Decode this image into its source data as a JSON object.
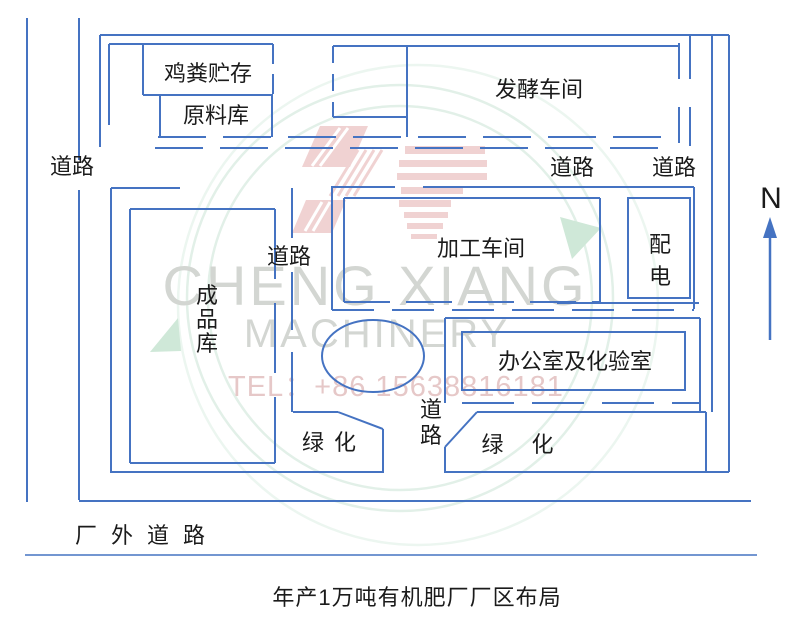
{
  "caption": {
    "text": "年产1万吨有机肥厂厂区布局"
  },
  "colors": {
    "line": "#4573c2",
    "text": "#1b1b1b",
    "bg": "#ffffff"
  },
  "compass": {
    "label": "N",
    "line": {
      "x": 770,
      "y1": 236,
      "y2": 340
    },
    "head_points": "770,217 763,238 777,238"
  },
  "labels": [
    {
      "name": "label-chicken-manure-storage",
      "text": "鸡粪贮存",
      "x": 208,
      "y": 81,
      "fs": 22
    },
    {
      "name": "label-raw-material-warehouse",
      "text": "原料库",
      "x": 216,
      "y": 123,
      "fs": 22
    },
    {
      "name": "label-fermentation-workshop",
      "text": "发酵车间",
      "x": 539,
      "y": 97,
      "fs": 22
    },
    {
      "name": "label-road-west",
      "text": "道路",
      "x": 72,
      "y": 174,
      "fs": 22
    },
    {
      "name": "label-road-mid-east",
      "text": "道路",
      "x": 572,
      "y": 175,
      "fs": 22
    },
    {
      "name": "label-road-east",
      "text": "道路",
      "x": 674,
      "y": 175,
      "fs": 22
    },
    {
      "name": "label-road-mid-west",
      "text": "道路",
      "x": 289,
      "y": 264,
      "fs": 22
    },
    {
      "name": "label-processing-workshop",
      "text": "加工车间",
      "x": 481,
      "y": 256,
      "fs": 22
    },
    {
      "name": "label-power-distribution",
      "text": "配电",
      "x": 660,
      "y": 252,
      "fs": 22,
      "vertical": true,
      "lh": 32
    },
    {
      "name": "label-finished-product-warehouse",
      "text": "成品库",
      "x": 207,
      "y": 303,
      "fs": 22,
      "vertical": true,
      "lh": 24
    },
    {
      "name": "label-office-and-lab",
      "text": "办公室及化验室",
      "x": 575,
      "y": 369,
      "fs": 22
    },
    {
      "name": "label-road-center",
      "text": "道路",
      "x": 431,
      "y": 417,
      "fs": 22,
      "vertical": true,
      "lh": 26
    },
    {
      "name": "label-green-area-west",
      "text": "绿 化",
      "x": 330,
      "y": 450,
      "fs": 22,
      "ls": 2
    },
    {
      "name": "label-green-area-east",
      "text": "绿 化",
      "x": 523,
      "y": 452,
      "fs": 22,
      "ls": 11
    },
    {
      "name": "label-outside-road",
      "text": "厂外道路",
      "x": 75,
      "y": 543,
      "fs": 22,
      "ls": 14,
      "anchor": "start"
    },
    {
      "name": "north-label",
      "text": "N",
      "x": 771,
      "y": 208,
      "fs": 30
    }
  ],
  "ellipse": {
    "name": "center-roundabout",
    "cx": 373,
    "cy": 356,
    "rx": 51,
    "ry": 36
  },
  "lines": [
    {
      "n": "outer-road-left-line-outer",
      "d": "M27,18 V502"
    },
    {
      "n": "outer-road-left-line-inner-a",
      "d": "M79,18 V160"
    },
    {
      "n": "outer-road-left-line-inner-b",
      "d": "M79,190 V500"
    },
    {
      "n": "outer-road-bottom-top-edge",
      "d": "M79,501 H751"
    },
    {
      "n": "outer-road-bottom-bottom-edge",
      "d": "M25,555 H757",
      "w": 1.6
    },
    {
      "n": "factory-wall-top",
      "d": "M100,35 H729"
    },
    {
      "n": "factory-wall-right",
      "d": "M729,35 V472"
    },
    {
      "n": "factory-wall-bottom-west",
      "d": "M110,472 H384"
    },
    {
      "n": "factory-wall-bottom-east",
      "d": "M444,472 H729"
    },
    {
      "n": "factory-wall-left-upper",
      "d": "M100,35 V147"
    },
    {
      "n": "factory-wall-left-lower",
      "d": "M111,188 V472"
    },
    {
      "n": "east-road-inner-line",
      "d": "M712,35 V412"
    },
    {
      "n": "storage-block-top",
      "d": "M109,44 H273"
    },
    {
      "n": "storage-block-left",
      "d": "M109,44 V125"
    },
    {
      "n": "manure-box-left",
      "d": "M143,44 V95"
    },
    {
      "n": "manure-box-bottom",
      "d": "M143,95 H273"
    },
    {
      "n": "manure-box-right",
      "d": "M273,44 V95",
      "dash": "20 10"
    },
    {
      "n": "raw-box-left",
      "d": "M160,95 V137"
    },
    {
      "n": "raw-box-right",
      "d": "M272,95 V137"
    },
    {
      "n": "top-road-upper-dashes",
      "d": "M158,137 H672",
      "dash": "48 17"
    },
    {
      "n": "top-road-lower-dashes",
      "d": "M155,148 H660",
      "dash": "48 17"
    },
    {
      "n": "fermentation-box-top",
      "d": "M333,46 H679"
    },
    {
      "n": "fermentation-box-left",
      "d": "M333,46 V117",
      "dash": "17 11"
    },
    {
      "n": "fermentation-subbox-bottom",
      "d": "M333,117 H407"
    },
    {
      "n": "fermentation-divider",
      "d": "M407,46 V137"
    },
    {
      "n": "fermentation-box-right-dashes",
      "d": "M679,43 V146",
      "dash": "36 28"
    },
    {
      "n": "east-entrance-edge",
      "d": "M690,35 V146",
      "dash": "44 28"
    },
    {
      "n": "processing-block-left",
      "d": "M332,186 V310"
    },
    {
      "n": "processing-block-top-a",
      "d": "M332,187 H395"
    },
    {
      "n": "processing-block-top-b",
      "d": "M423,187 H694"
    },
    {
      "n": "processing-block-right",
      "d": "M694,187 V309"
    },
    {
      "n": "processing-block-bottom",
      "d": "M332,310 H694",
      "dash": "42 18"
    },
    {
      "n": "processing-box-top",
      "d": "M344,198 H600"
    },
    {
      "n": "processing-box-left",
      "d": "M344,198 V302"
    },
    {
      "n": "processing-box-right",
      "d": "M600,198 V302"
    },
    {
      "n": "processing-box-bottom",
      "d": "M344,302 H600",
      "dash": "46 16"
    },
    {
      "n": "power-box-outline",
      "d": "M628,198 H690 V298 H628 Z"
    },
    {
      "n": "product-box-top",
      "d": "M130,209 H275"
    },
    {
      "n": "product-box-left",
      "d": "M130,209 V463"
    },
    {
      "n": "product-box-bottom",
      "d": "M130,463 H275"
    },
    {
      "n": "product-box-right",
      "d": "M275,209 V463",
      "dash": "70 24"
    },
    {
      "n": "wall-top-west-tick",
      "d": "M111,188 H180"
    },
    {
      "n": "west-inner-road-a",
      "d": "M292,188 V238"
    },
    {
      "n": "west-inner-road-b",
      "d": "M292,272 V330"
    },
    {
      "n": "west-inner-road-c",
      "d": "M292,352 V412"
    },
    {
      "n": "office-block-left",
      "d": "M445,318 V403"
    },
    {
      "n": "office-block-top",
      "d": "M445,318 H700"
    },
    {
      "n": "office-block-right",
      "d": "M700,318 V412"
    },
    {
      "n": "office-block-bottom",
      "d": "M462,403 H700",
      "dash": "52 18"
    },
    {
      "n": "office-box-outline",
      "d": "M462,332 H685 V390 H462 Z"
    },
    {
      "n": "office-road-edge",
      "d": "M557,303 H699"
    },
    {
      "n": "green-west-top",
      "d": "M293,412 H338"
    },
    {
      "n": "green-west-slope",
      "d": "M338,412 L383,429"
    },
    {
      "n": "green-west-right",
      "d": "M383,429 V471"
    },
    {
      "n": "green-east-top",
      "d": "M477,412 H706"
    },
    {
      "n": "green-east-slope",
      "d": "M477,412 L445,447"
    },
    {
      "n": "green-east-left",
      "d": "M445,447 V471"
    },
    {
      "n": "green-east-right",
      "d": "M706,412 V471"
    }
  ],
  "watermark": {
    "arc_color": "#e2f0e8",
    "arc_color_light": "#ecf6f0",
    "triangle_color": "#cfe8d8",
    "logo_color": "#f0d2d2",
    "letter_color": "#d3d6d2",
    "tel_color": "#e6c8c8",
    "circles": [
      {
        "cx": 400,
        "cy": 298,
        "r": 213
      },
      {
        "cx": 400,
        "cy": 298,
        "r": 192
      },
      {
        "cx": 418,
        "cy": 305,
        "r": 240,
        "light": true
      }
    ],
    "triangles": [
      {
        "pts": "560,217 601,228 572,259"
      },
      {
        "pts": "150,352 178,318 181,351"
      }
    ],
    "logo_polys": [
      "320,126 368,126 350,167 302,167",
      "306,200 346,200 332,233 292,233"
    ],
    "logo_bars": [
      [
        405,
        146,
        80,
        8
      ],
      [
        399,
        160,
        88,
        7
      ],
      [
        397,
        173,
        90,
        7
      ],
      [
        401,
        187,
        62,
        7
      ],
      [
        399,
        200,
        52,
        7
      ],
      [
        404,
        212,
        44,
        6
      ],
      [
        407,
        223,
        36,
        6
      ],
      [
        411,
        234,
        26,
        5
      ]
    ],
    "logo_stripes": [
      {
        "x1": 358,
        "y1": 150,
        "x2": 330,
        "y2": 196
      },
      {
        "x1": 366,
        "y1": 150,
        "x2": 338,
        "y2": 196
      },
      {
        "x1": 374,
        "y1": 150,
        "x2": 346,
        "y2": 196
      },
      {
        "x1": 382,
        "y1": 150,
        "x2": 354,
        "y2": 196
      }
    ],
    "white_stripes": [
      {
        "x1": 340,
        "y1": 128,
        "x2": 312,
        "y2": 166
      },
      {
        "x1": 348,
        "y1": 128,
        "x2": 320,
        "y2": 166
      },
      {
        "x1": 322,
        "y1": 202,
        "x2": 305,
        "y2": 231
      },
      {
        "x1": 330,
        "y1": 202,
        "x2": 313,
        "y2": 231
      }
    ],
    "texts": [
      {
        "name": "watermark-brand-line1",
        "text": "CHENG XIANG",
        "x": 375,
        "y": 305,
        "fs": 56,
        "ls": 3
      },
      {
        "name": "watermark-brand-line2",
        "text": "MACHINERY",
        "x": 377,
        "y": 347,
        "fs": 40,
        "ls": 3
      },
      {
        "name": "watermark-tel",
        "text": "TEL：+86 15638816181",
        "x": 228,
        "y": 396,
        "fs": 29,
        "ls": 1,
        "pink": true,
        "anchor": "start"
      }
    ]
  }
}
